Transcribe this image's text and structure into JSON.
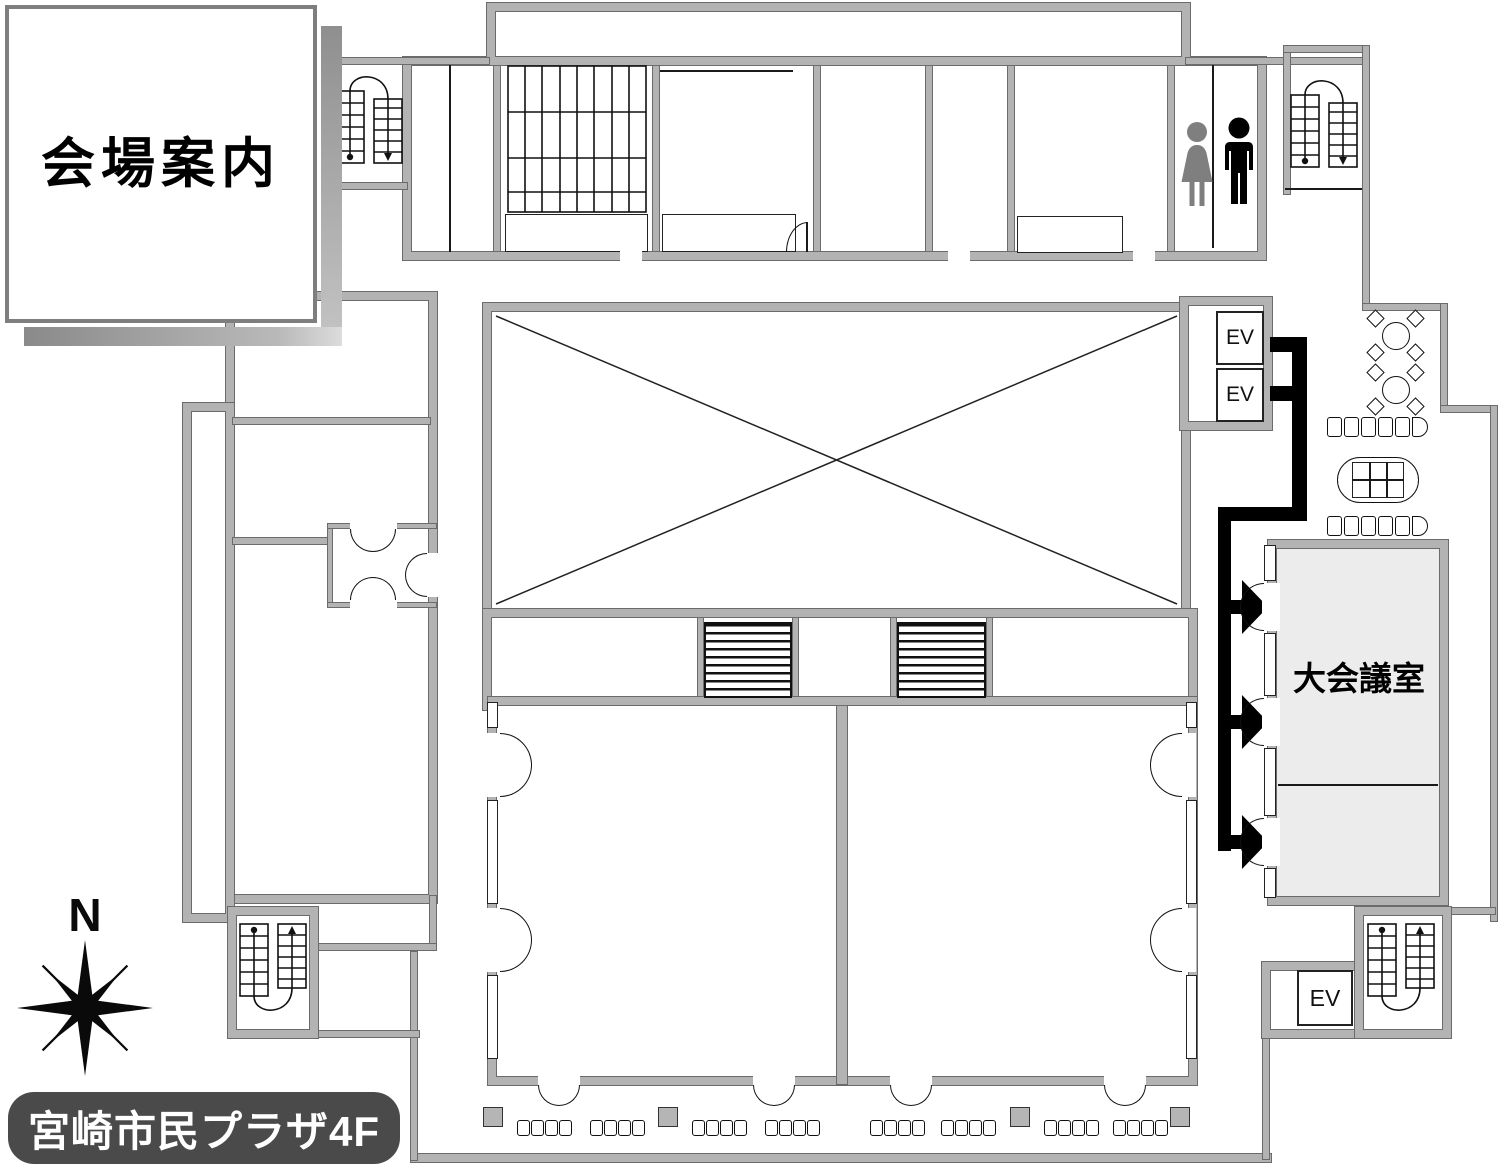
{
  "title_card": {
    "title": "会場案内"
  },
  "floor_label": {
    "text": "宮崎市民プラザ4F"
  },
  "compass": {
    "north": "N"
  },
  "rooms": {
    "large_conference_room": "大会議室"
  },
  "elevator": {
    "label": "EV",
    "count_visible": 3
  },
  "icons": {
    "stairs": "stairs-icon",
    "woman": "woman-icon",
    "man": "man-icon",
    "compass_rose": "compass-rose-icon",
    "route_arrow": "route-arrow-icon"
  },
  "colors": {
    "wall": "#b3b3b3",
    "wall_edge": "#6b6b6b",
    "route": "#000000",
    "conference_fill": "#ececec",
    "floor_label_bg": "#4a4a4a",
    "woman_icon": "#7f7f7f",
    "man_icon": "#000000"
  }
}
